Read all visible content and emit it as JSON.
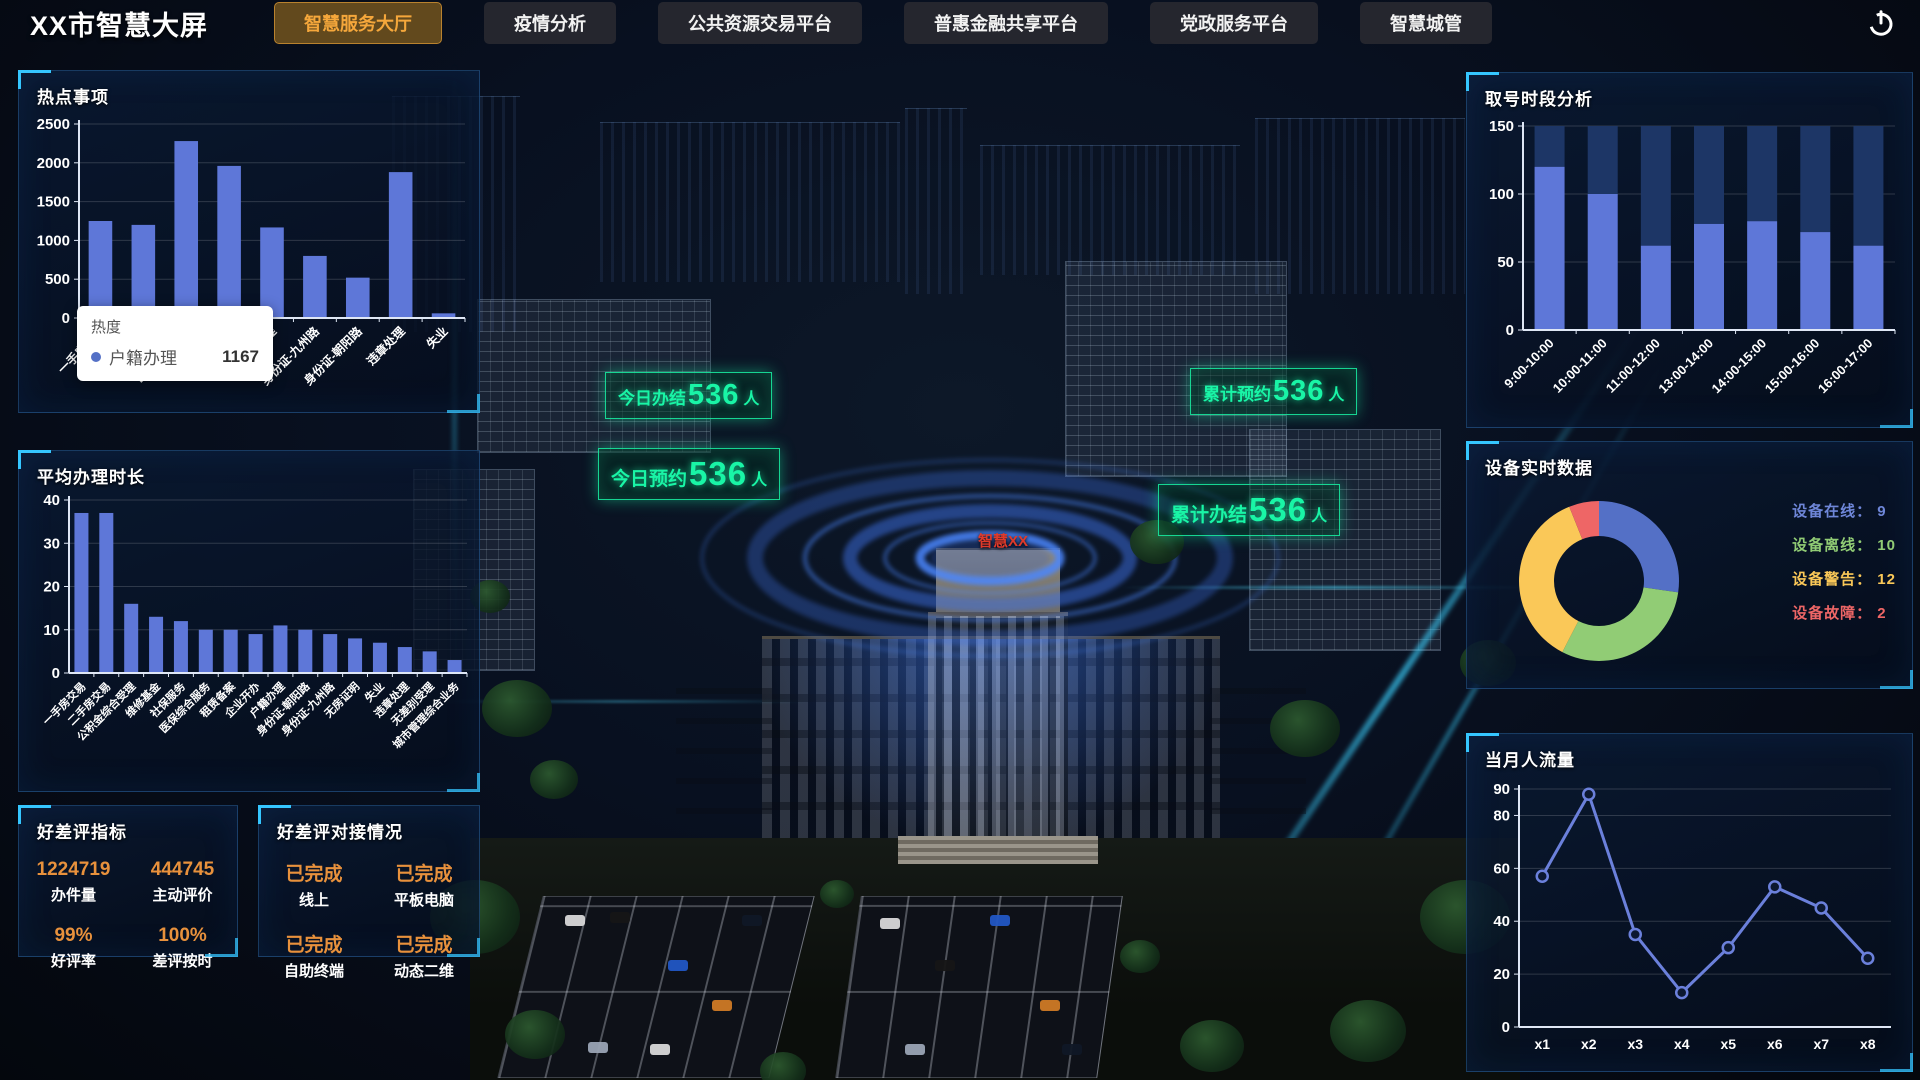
{
  "app": {
    "title": "XX市智慧大屏"
  },
  "nav": {
    "tabs": [
      {
        "label": "智慧服务大厅",
        "active": true
      },
      {
        "label": "疫情分析",
        "active": false
      },
      {
        "label": "公共资源交易平台",
        "active": false
      },
      {
        "label": "普惠金融共享平台",
        "active": false
      },
      {
        "label": "党政服务平台",
        "active": false
      },
      {
        "label": "智慧城管",
        "active": false
      }
    ]
  },
  "left": {
    "hot_items_title": "热点事项",
    "tooltip": {
      "title": "热度",
      "series": "户籍办理",
      "value": "1167"
    },
    "avg_time_title": "平均办理时长",
    "rating_metrics": {
      "title": "好差评指标",
      "metrics": [
        {
          "value": "1224719",
          "label": "办件量"
        },
        {
          "value": "444745",
          "label": "主动评价"
        },
        {
          "value": "99%",
          "label": "好评率"
        },
        {
          "value": "100%",
          "label": "差评按时"
        }
      ]
    },
    "rating_status": {
      "title": "好差评对接情况",
      "items": [
        {
          "status": "已完成",
          "label": "线上"
        },
        {
          "status": "已完成",
          "label": "平板电脑"
        },
        {
          "status": "已完成",
          "label": "自助终端"
        },
        {
          "status": "已完成",
          "label": "动态二维"
        }
      ]
    }
  },
  "right": {
    "queue_title": "取号时段分析",
    "device_title": "设备实时数据",
    "flow_title": "当月人流量",
    "device_legend": [
      {
        "label": "设备在线",
        "value": "9",
        "color": "#6e86d8"
      },
      {
        "label": "设备离线",
        "value": "10",
        "color": "#91cc75"
      },
      {
        "label": "设备警告",
        "value": "12",
        "color": "#fac858"
      },
      {
        "label": "设备故障",
        "value": "2",
        "color": "#ee6666"
      }
    ]
  },
  "scene": {
    "building_label": "智慧XX",
    "accent_green": "#19f5a6",
    "labels": [
      {
        "prefix": "今日办结",
        "num": "536",
        "suffix": "人"
      },
      {
        "prefix": "今日预约",
        "num": "536",
        "suffix": "人"
      },
      {
        "prefix": "累计预约",
        "num": "536",
        "suffix": "人"
      },
      {
        "prefix": "累计办结",
        "num": "536",
        "suffix": "人"
      }
    ]
  },
  "chart_data": [
    {
      "id": "hot-items",
      "type": "bar",
      "title": "热点事项",
      "categories": [
        "一手房交易",
        "二手房交易",
        "医保综合服务",
        "社保服务",
        "户籍办理",
        "身份证-九州路",
        "身份证-朝阳路",
        "违章处理",
        "失业"
      ],
      "values": [
        1250,
        1200,
        2280,
        1960,
        1167,
        800,
        520,
        1880,
        60
      ],
      "xlabel": "",
      "ylabel": "",
      "ylim": [
        0,
        2500
      ],
      "yticks": [
        0,
        500,
        1000,
        1500,
        2000,
        2500
      ],
      "bar_color": "#5e77d8",
      "grid": true,
      "legend_position": "none"
    },
    {
      "id": "avg-time",
      "type": "bar",
      "title": "平均办理时长",
      "categories": [
        "一手房交易",
        "二手房交易",
        "公积金综合受理",
        "维修基金",
        "社保服务",
        "医保综合服务",
        "租赁备案",
        "企业开办",
        "户籍办理",
        "身份证-朝阳路",
        "身份证-九州路",
        "无房证明",
        "失业",
        "违章处理",
        "无差别受理",
        "城市管理综合业务"
      ],
      "values": [
        37,
        37,
        16,
        13,
        12,
        10,
        10,
        9,
        11,
        10,
        9,
        8,
        7,
        6,
        5,
        3
      ],
      "xlabel": "",
      "ylabel": "",
      "ylim": [
        0,
        40
      ],
      "yticks": [
        0,
        10,
        20,
        30,
        40
      ],
      "bar_color": "#5e77d8",
      "grid": true,
      "legend_position": "none"
    },
    {
      "id": "queue",
      "type": "bar",
      "title": "取号时段分析",
      "categories": [
        "9:00-10:00",
        "10:00-11:00",
        "11:00-12:00",
        "13:00-14:00",
        "14:00-15:00",
        "15:00-16:00",
        "16:00-17:00"
      ],
      "values": [
        120,
        100,
        62,
        78,
        80,
        72,
        62
      ],
      "track_to": 150,
      "track_color": "#1d3666",
      "xlabel": "",
      "ylabel": "",
      "ylim": [
        0,
        150
      ],
      "yticks": [
        0,
        50,
        100,
        150
      ],
      "bar_color": "#5e77d8",
      "grid": true,
      "legend_position": "none"
    },
    {
      "id": "device",
      "type": "pie",
      "title": "设备实时数据",
      "donut": true,
      "slices": [
        {
          "label": "设备在线",
          "value": 9,
          "color": "#5470c6"
        },
        {
          "label": "设备离线",
          "value": 10,
          "color": "#91cc75"
        },
        {
          "label": "设备警告",
          "value": 12,
          "color": "#fac858"
        },
        {
          "label": "设备故障",
          "value": 2,
          "color": "#ee6666"
        }
      ]
    },
    {
      "id": "flow",
      "type": "line",
      "title": "当月人流量",
      "x": [
        "x1",
        "x2",
        "x3",
        "x4",
        "x5",
        "x6",
        "x7",
        "x8"
      ],
      "values": [
        57,
        88,
        35,
        13,
        30,
        53,
        45,
        26
      ],
      "xlabel": "",
      "ylabel": "",
      "ylim": [
        0,
        90
      ],
      "yticks": [
        0,
        20,
        40,
        60,
        80,
        90
      ],
      "line_color": "#6b80db",
      "grid": true,
      "legend_position": "none"
    }
  ]
}
